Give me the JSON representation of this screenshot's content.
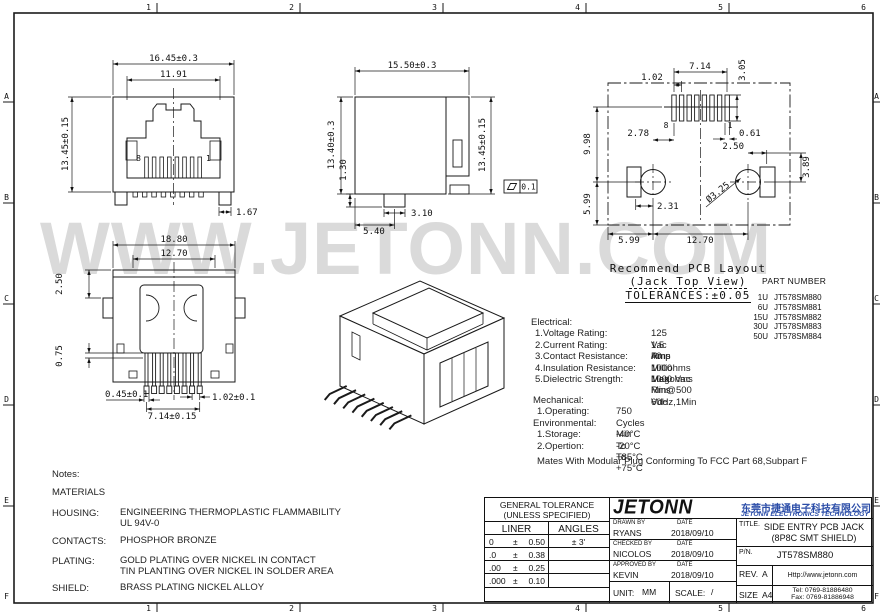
{
  "frame": {
    "cols": [
      "1",
      "2",
      "3",
      "4",
      "5",
      "6"
    ],
    "rows": [
      "A",
      "B",
      "C",
      "D",
      "E",
      "F"
    ]
  },
  "watermark": "WWW.JETONN.COM",
  "views": {
    "front": {
      "dim_width": "16.45±0.3",
      "dim_opening": "11.91",
      "dim_height": "13.45±0.15",
      "dim_foot": "1.67",
      "pin_left": "8",
      "pin_right": "1"
    },
    "side": {
      "dim_depth": "15.50±0.3",
      "dim_height_left": "13.40±0.3",
      "dim_standoff": "1.30",
      "dim_post_width": "3.10",
      "dim_post_offset": "5.40",
      "dim_height_right": "13.45±0.15",
      "flatness_value": "0.1"
    },
    "pcb_layout": {
      "dim_pad_span": "7.14",
      "dim_pad_pitch": "1.02",
      "dim_pad_length": "3.05",
      "dim_pads_to_holes": "9.98",
      "dim_hole_offset_left": "2.78",
      "dim_pad_width": "0.61",
      "dim_hole_offset_right": "2.50",
      "dim_tab_height": "3.89",
      "dim_edge_left": "5.99",
      "dim_tab_width": "2.31",
      "dim_hole_dia": "Ø3.25",
      "dim_bottom_left": "5.99",
      "dim_hole_span": "12.70",
      "pin_left": "8",
      "pin_right": "1"
    },
    "bottom": {
      "dim_width": "18.80",
      "dim_inner_width": "12.70",
      "dim_top_offset": "2.50",
      "dim_pin_depth": "0.75",
      "dim_pin_width": "0.45±0.1",
      "dim_pin_span": "7.14±0.15",
      "dim_pin_pitch": "1.02±0.1"
    }
  },
  "pcb_note": {
    "line1": "Recommend PCB Layout",
    "line2": "(Jack Top View)",
    "line3": "TOLERANCES:±0.05"
  },
  "part_list": {
    "title": "PART NUMBER",
    "items": [
      {
        "code": "1U",
        "pn": "JT578SM880"
      },
      {
        "code": "6U",
        "pn": "JT578SM881"
      },
      {
        "code": "15U",
        "pn": "JT578SM882"
      },
      {
        "code": "30U",
        "pn": "JT578SM883"
      },
      {
        "code": "50U",
        "pn": "JT578SM884"
      }
    ]
  },
  "specs": {
    "electrical": {
      "title": "Electrical:",
      "rows": [
        {
          "label": "1.Voltage Rating:",
          "value": "125 Vac Rms"
        },
        {
          "label": "2.Current Rating:",
          "value": "1.5 Amp"
        },
        {
          "label": "3.Contact Resistance:",
          "value": "40 Milliohms Max"
        },
        {
          "label": "4.Insulation Resistance:",
          "value": "1000 Megohms Min@500 Vdc"
        },
        {
          "label": "5.Dielectric Strength:",
          "value": "1000 Vac Rms 60Hz,1Min"
        }
      ]
    },
    "mechanical": {
      "title": "Mechanical:",
      "rows": [
        {
          "label": "1.Operating:",
          "value": "750 Cycles Min"
        }
      ]
    },
    "environmental": {
      "title": "Environmental:",
      "rows": [
        {
          "label": "1.Storage:",
          "value": "-40°C To +85°C"
        },
        {
          "label": "2.Opertion:",
          "value": "-20°C To +75°C"
        }
      ]
    },
    "mates_note": "Mates With Modular Plug Conforming To FCC Part 68,Subpart F"
  },
  "notes": {
    "title": "Notes:",
    "materials_heading": "MATERIALS",
    "rows": [
      {
        "label": "HOUSING:",
        "value": "ENGINEERING THERMOPLASTIC FLAMMABILITY",
        "value2": "UL 94V-0"
      },
      {
        "label": "CONTACTS:",
        "value": "PHOSPHOR BRONZE",
        "value2": ""
      },
      {
        "label": "PLATING:",
        "value": "GOLD PLATING OVER NICKEL IN CONTACT",
        "value2": "TIN PLANTING OVER NICKEL IN SOLDER AREA"
      },
      {
        "label": "SHIELD:",
        "value": "BRASS PLATING NICKEL ALLOY",
        "value2": ""
      }
    ]
  },
  "title_block": {
    "tolerance": {
      "header1": "GENERAL TOLERANCE",
      "header2": "(UNLESS SPECIFIED)",
      "col_liner": "LINER",
      "col_angles": "ANGLES",
      "angle_tol": "± 3'",
      "rows": [
        {
          "digits": "0",
          "pm": "±",
          "val": "0.50"
        },
        {
          "digits": ".0",
          "pm": "±",
          "val": "0.38"
        },
        {
          "digits": ".00",
          "pm": "±",
          "val": "0.25"
        },
        {
          "digits": ".000",
          "pm": "±",
          "val": "0.10"
        }
      ]
    },
    "logo_text": "JETONN",
    "company_cn": "东莞市捷通电子科技有限公司",
    "company_en": "JETONN ELECTRONICS TECHNOLOGY",
    "sign_rows": [
      {
        "role": "DRAWN BY",
        "name": "RYANS",
        "date_label": "DATE",
        "date": "2018/09/10"
      },
      {
        "role": "CHECKED BY",
        "name": "NICOLOS",
        "date_label": "DATE",
        "date": "2018/09/10"
      },
      {
        "role": "APPROVED BY",
        "name": "KEVIN",
        "date_label": "DATE",
        "date": "2018/09/10"
      }
    ],
    "unit_label": "UNIT:",
    "unit_value": "MM",
    "scale_label": "SCALE:",
    "scale_value": "/",
    "title_label": "TITLE.",
    "title_line1": "SIDE ENTRY PCB JACK",
    "title_line2": "(8P8C SMT SHIELD)",
    "pn_label": "P/N.",
    "pn_value": "JT578SM880",
    "rev_label": "REV.",
    "rev_value": "A",
    "size_label": "SIZE",
    "size_value": "A4",
    "website": "Http://www.jetonn.com",
    "tel": "Tel: 0769-81886480",
    "fax": "Fax: 0769-81886948"
  },
  "colors": {
    "accent_blue": "#2b4da8",
    "line": "#1a1a1a",
    "watermark": "#dadada"
  }
}
